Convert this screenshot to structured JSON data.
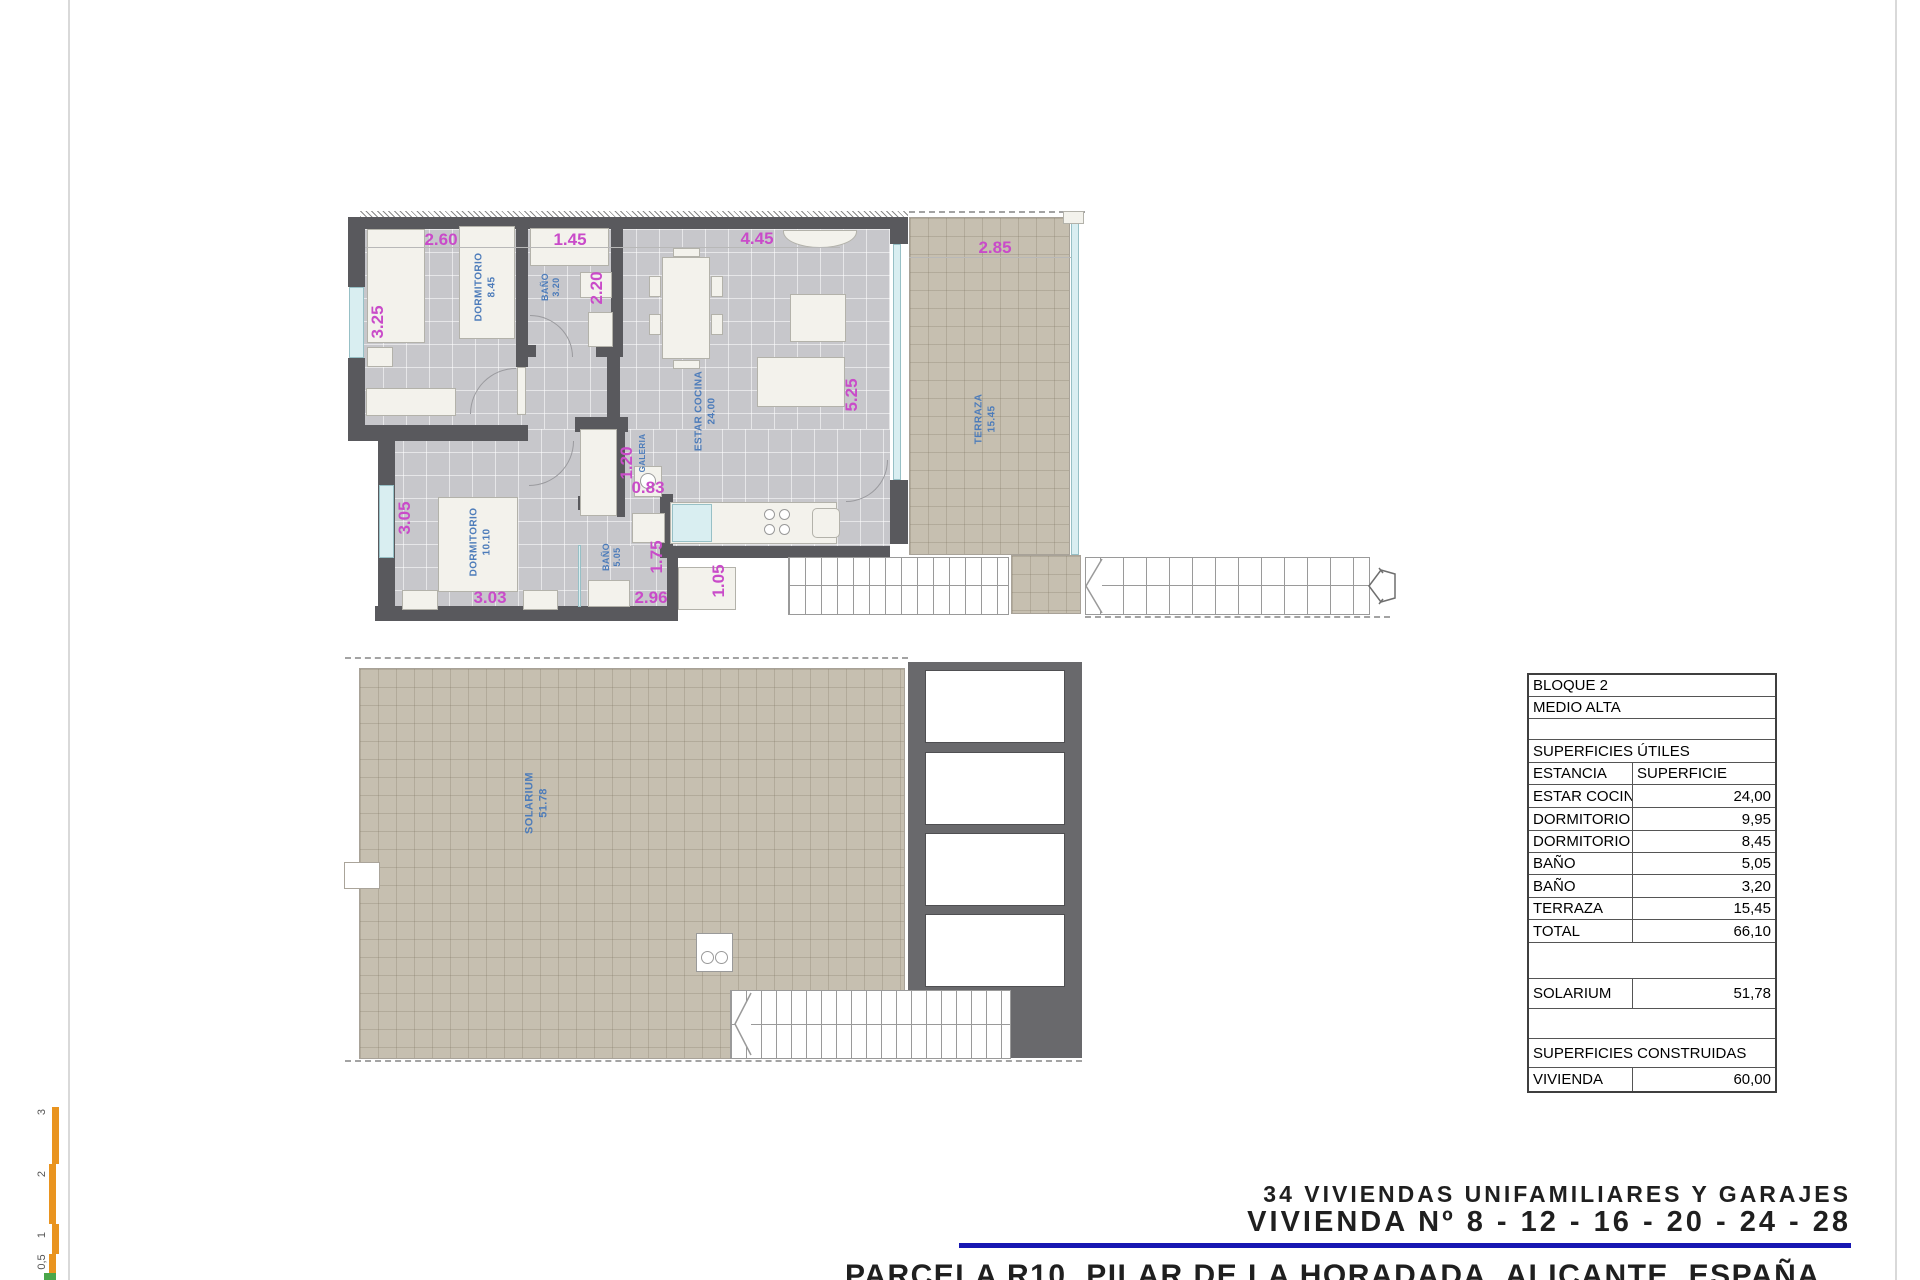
{
  "floor_plan": {
    "rooms": {
      "dormitorio_1": {
        "name": "DORMITORIO",
        "area": "8.45"
      },
      "bano_1": {
        "name": "BAÑO",
        "area": "3.20"
      },
      "estar_cocina": {
        "name": "ESTAR COCINA",
        "area": "24.00"
      },
      "galeria": {
        "name": "GALERIA"
      },
      "dormitorio_2": {
        "name": "DORMITORIO",
        "area": "10.10"
      },
      "bano_2": {
        "name": "BAÑO",
        "area": "5.05"
      },
      "terraza": {
        "name": "TERRAZA",
        "area": "15.45"
      }
    },
    "dimensions": {
      "d_2_60": "2.60",
      "d_1_45": "1.45",
      "d_4_45": "4.45",
      "d_2_85": "2.85",
      "d_3_25": "3.25",
      "d_2_20": "2.20",
      "d_5_25": "5.25",
      "d_3_05": "3.05",
      "d_1_20": "1.20",
      "d_0_83": "0.83",
      "d_1_75": "1.75",
      "d_1_05": "1.05",
      "d_3_03": "3.03",
      "d_2_96": "2.96"
    }
  },
  "solarium_plan": {
    "room": {
      "name": "SOLARIUM",
      "area": "51.78"
    }
  },
  "summary_table": {
    "rows": [
      {
        "label": "BLOQUE 2",
        "value": ""
      },
      {
        "label": "MEDIO ALTA",
        "value": ""
      },
      {
        "label": "",
        "value": ""
      },
      {
        "label": "SUPERFICIES ÚTILES",
        "value": ""
      },
      {
        "label": "ESTANCIA",
        "value": "SUPERFICIE"
      },
      {
        "label": "ESTAR COCINA",
        "value": "24,00"
      },
      {
        "label": "DORMITORIO",
        "value": "9,95"
      },
      {
        "label": "DORMITORIO",
        "value": "8,45"
      },
      {
        "label": "BAÑO",
        "value": "5,05"
      },
      {
        "label": "BAÑO",
        "value": "3,20"
      },
      {
        "label": "TERRAZA",
        "value": "15,45"
      },
      {
        "label": "TOTAL",
        "value": "66,10"
      },
      {
        "label": "",
        "value": ""
      },
      {
        "label": "SOLARIUM",
        "value": "51,78"
      },
      {
        "label": "",
        "value": ""
      },
      {
        "label": "SUPERFICIES CONSTRUIDAS",
        "value": ""
      },
      {
        "label": "VIVIENDA",
        "value": "60,00"
      }
    ]
  },
  "title_block": {
    "line1": "34 VIVIENDAS UNIFAMILIARES Y GARAJES",
    "line2": "VIVIENDA Nº 8 - 12 - 16 - 20 - 24 - 28",
    "line3": "PARCELA R10, PILAR DE LA HORADADA, ALICANTE, ESPAÑA"
  },
  "scale_bar": {
    "labels": [
      "3",
      "2",
      "1",
      "0,5"
    ]
  },
  "colors": {
    "dimension_text": "#c94bc9",
    "room_label_text": "#4d7cba",
    "title_underline": "#1717b2",
    "wall": "#59595d",
    "terrace_tile": "#c6bfb0",
    "floor_tile": "#c7c7cb",
    "scale_bar_orange": "#e9941f"
  }
}
